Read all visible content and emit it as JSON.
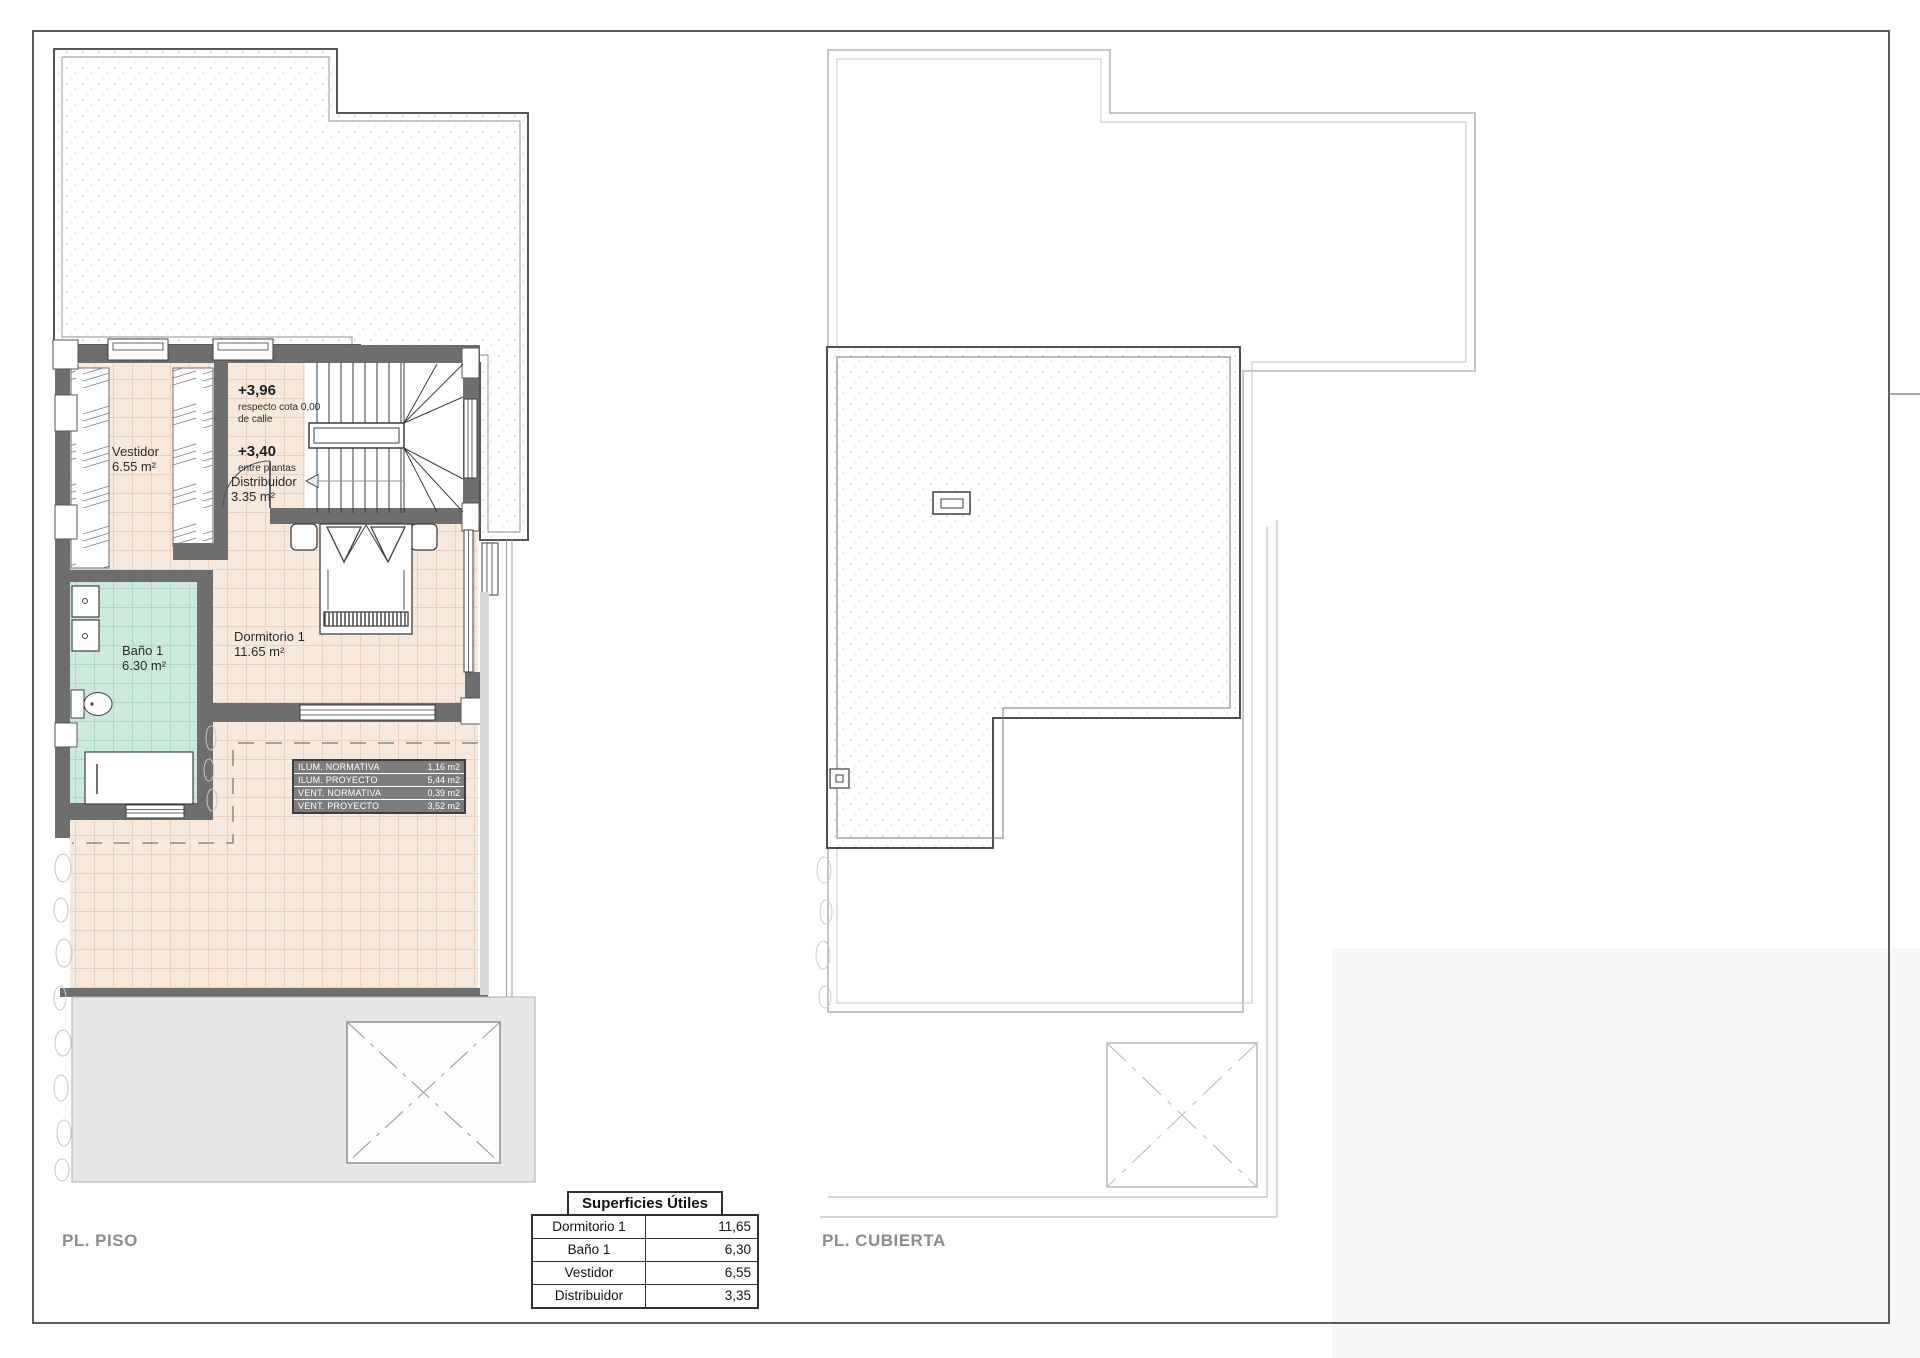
{
  "sheet": {
    "piso_label": "PL. PISO",
    "cubierta_label": "PL. CUBIERTA"
  },
  "rooms": {
    "vestidor": {
      "name": "Vestidor",
      "area": "6.55 m²"
    },
    "banio": {
      "name": "Baño 1",
      "area": "6.30 m²"
    },
    "dormitorio": {
      "name": "Dormitorio 1",
      "area": "11.65 m²"
    },
    "distribuidor": {
      "name": "Distribuidor",
      "area": "3.35 m²"
    }
  },
  "levels": {
    "upper": {
      "value": "+3,96",
      "note1": "respecto cota 0,00",
      "note2": "de calle"
    },
    "mid": {
      "value": "+3,40",
      "note1": "entre plantas"
    }
  },
  "vent_table": {
    "rows": [
      {
        "label": "ILUM. NORMATIVA",
        "value": "1,16 m2"
      },
      {
        "label": "ILUM. PROYECTO",
        "value": "5,44 m2"
      },
      {
        "label": "VENT. NORMATIVA",
        "value": "0,39 m2"
      },
      {
        "label": "VENT. PROYECTO",
        "value": "3,52 m2"
      }
    ]
  },
  "areas_table": {
    "title": "Superficies Útiles",
    "rows": [
      {
        "name": "Dormitorio 1",
        "value": "11,65"
      },
      {
        "name": "Baño 1",
        "value": "6,30"
      },
      {
        "name": "Vestidor",
        "value": "6,55"
      },
      {
        "name": "Distribuidor",
        "value": "3,35"
      }
    ]
  },
  "colors": {
    "wall": "#6e6e6e",
    "floor_tile": "#f7e9db",
    "bath_tile": "#cce9dc",
    "vent_table_bg": "#7c7c7c",
    "outline_light": "#b5b5b5"
  }
}
